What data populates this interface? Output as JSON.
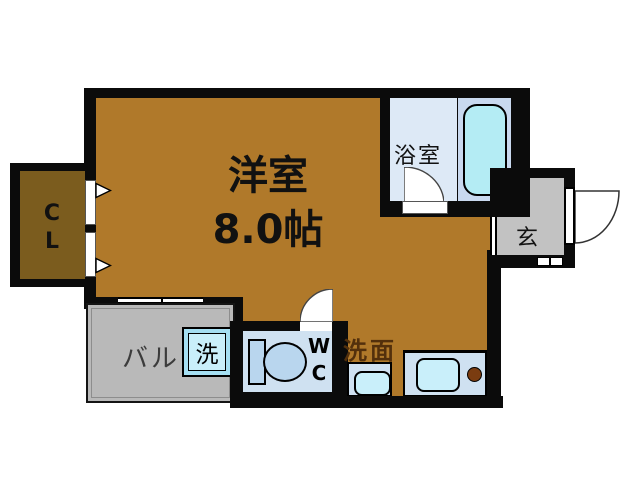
{
  "floorplan": {
    "title": "apartment-floor-plan",
    "rooms": {
      "main_room": {
        "name": "洋室",
        "size": "8.0帖"
      },
      "bathroom": {
        "name": "浴室"
      },
      "closet": {
        "line1": "C",
        "line2": "L"
      },
      "balcony": {
        "name": "バル"
      },
      "washer": {
        "name": "洗"
      },
      "toilet": {
        "line1": "W",
        "line2": "C"
      },
      "washroom": {
        "name": "洗面"
      },
      "entrance": {
        "name": "玄"
      }
    },
    "colors": {
      "wall": "#0b0b0b",
      "floor": "#b0792a",
      "closet": "#7b5c1e",
      "balcony": "#b9b9b9",
      "entry": "#c2c2c2",
      "bath-pale": "#dde9f6",
      "tub-area": "#c9d9ef",
      "tub": "#b4ecf4",
      "fixture-panel": "#cfe1f1",
      "fixture-light": "#c9effa",
      "washer-frame": "#a5dff2",
      "toilet": "#b9d6ee",
      "burner": "#7a3c10",
      "washroom-label": "#53300c"
    }
  }
}
